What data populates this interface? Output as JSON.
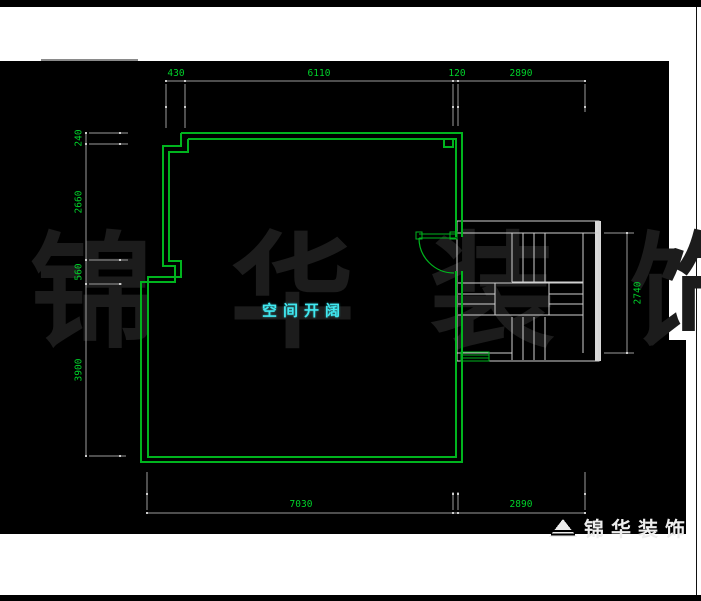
{
  "room_label": {
    "text": "空间开阔",
    "color": "#40e8f0"
  },
  "watermark": {
    "text": "锦华装饰",
    "color": "#1c1c1c"
  },
  "logo": {
    "text": "锦华装饰",
    "icon": "pyramid-logo-icon"
  },
  "dims": {
    "top": [
      "430",
      "6110",
      "120",
      "2890"
    ],
    "bottom": [
      "7030",
      "2890"
    ],
    "left": [
      "240",
      "2660",
      "560",
      "3900"
    ],
    "right": [
      "2740"
    ]
  },
  "colors": {
    "canvas": "#000000",
    "margin": "#ffffff",
    "wall_green": "#00b41e",
    "dim_text_green": "#00d22a",
    "dim_line_gray": "#9b9b9b",
    "stair_white": "#d0d0d0",
    "label_cyan": "#40e8f0",
    "watermark_gray": "#1c1c1c"
  }
}
